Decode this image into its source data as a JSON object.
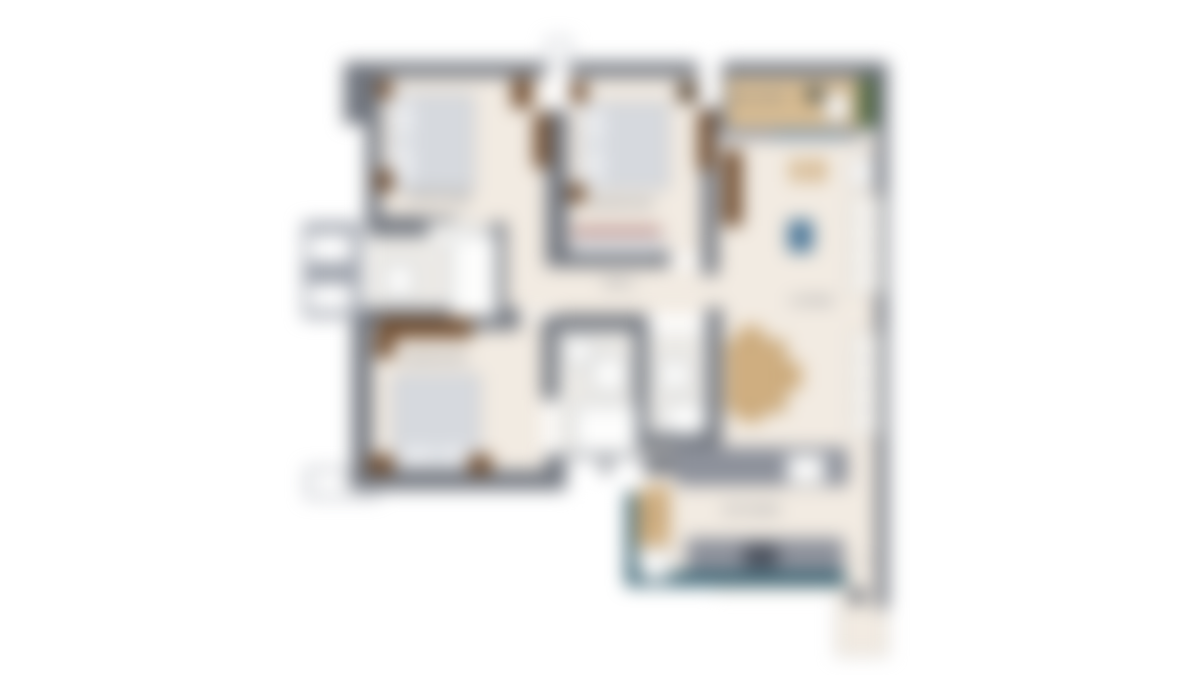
{
  "plan": {
    "type": "floor-plan",
    "blur_px": 9,
    "colors": {
      "wall": "#71767f",
      "wallLight": "#9ba0aa",
      "floor": "#f2ebe2",
      "floorBath": "#eceae6",
      "bed": "#d6d9de",
      "pillow": "#eef0f3",
      "bedBorder": "#b5bac3",
      "wood": "#cfae80",
      "deck": "#d8bc92",
      "brown": "#6e4a2c",
      "darkBrown": "#54422f",
      "green": "#4e6742",
      "teal": "#2f5d6e",
      "blue": "#4b7799",
      "counter": "#8d919b",
      "counterDark": "#4a505c",
      "benchRed": "#b1736a",
      "label": "#6f757f",
      "fixtureBorder": "#aab0b8"
    },
    "rooms": [
      {
        "id": "bedroom-1",
        "label": "BEDROOM"
      },
      {
        "id": "bedroom-2",
        "label": "BEDROOM"
      },
      {
        "id": "bedroom-3",
        "label": "BEDROOM"
      },
      {
        "id": "hall",
        "label": "HALL"
      },
      {
        "id": "living",
        "label": "LIVING"
      },
      {
        "id": "kitchen",
        "label": "KITCHEN"
      },
      {
        "id": "balcony",
        "label": "BALCONY"
      }
    ]
  }
}
